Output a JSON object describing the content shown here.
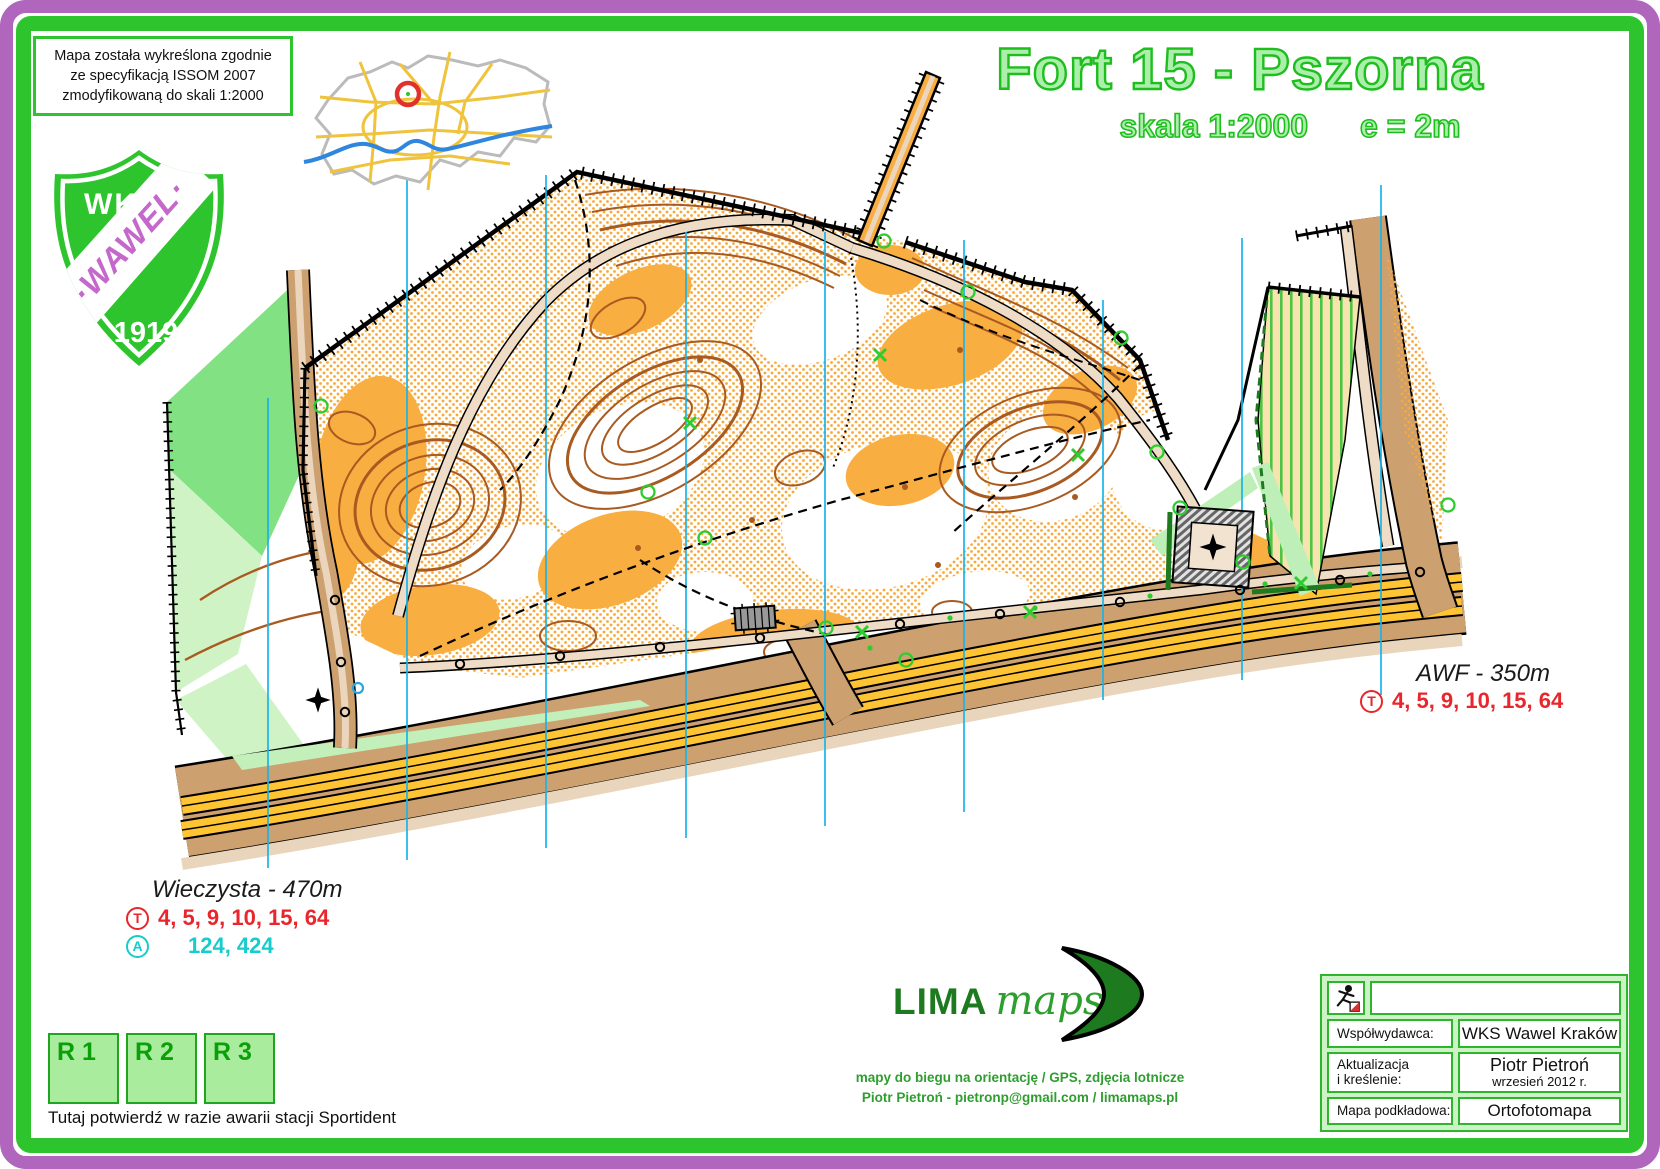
{
  "header": {
    "issom_note": {
      "line1": "Mapa została wykreślona zgodnie",
      "line2": "ze specyfikacją ISSOM 2007",
      "line3": "zmodyfikowaną do skali 1:2000"
    },
    "title": "Fort 15 - Pszorna",
    "scale_label": "skala 1:2000",
    "equidistance_label": "e = 2m"
  },
  "crest": {
    "club_initials": "WKS",
    "club_name": "·WAWEL·",
    "year": "1919"
  },
  "stops": {
    "awf": {
      "name": "AWF - 350m",
      "tram_symbol": "T",
      "tram_lines": "4, 5, 9, 10, 15, 64"
    },
    "wieczysta": {
      "name": "Wieczysta - 470m",
      "tram_symbol": "T",
      "tram_lines": "4, 5, 9, 10, 15, 64",
      "bus_symbol": "A",
      "bus_lines": "124, 424"
    }
  },
  "sportident": {
    "boxes": [
      "R 1",
      "R 2",
      "R 3"
    ],
    "note": "Tutaj potwierdź w razie awarii stacji Sportident"
  },
  "publisher": {
    "brand": "LIMA",
    "brand_suffix": "maps",
    "tagline1": "mapy do biegu na orientację / GPS, zdjęcia lotnicze",
    "tagline2": "Piotr Pietroń - pietronp@gmail.com / limamaps.pl"
  },
  "credits": {
    "rows": [
      {
        "label": "Współwydawca:",
        "value": "WKS Wawel Kraków"
      },
      {
        "label_line1": "Aktualizacja",
        "label_line2": "i kreślenie:",
        "value": "Piotr Pietroń",
        "value_sub": "wrzesień 2012 r."
      },
      {
        "label": "Mapa podkładowa:",
        "value": "Ortofotomapa"
      }
    ]
  },
  "colors": {
    "frame_purple": "#AF66BC",
    "frame_green": "#2DC42D",
    "title_fill": "#ABEFAB",
    "title_stroke": "#1EBE1E",
    "rough_open_orange": "#F9AE42",
    "contour_brown": "#A85A20",
    "north_line_cyan": "#19B4E8",
    "road_tan": "#CDA070",
    "paved_yellow": "#FFC433",
    "tram_red": "#E8262B",
    "bus_cyan": "#16CCCC",
    "crest_purple": "#C468CC"
  }
}
